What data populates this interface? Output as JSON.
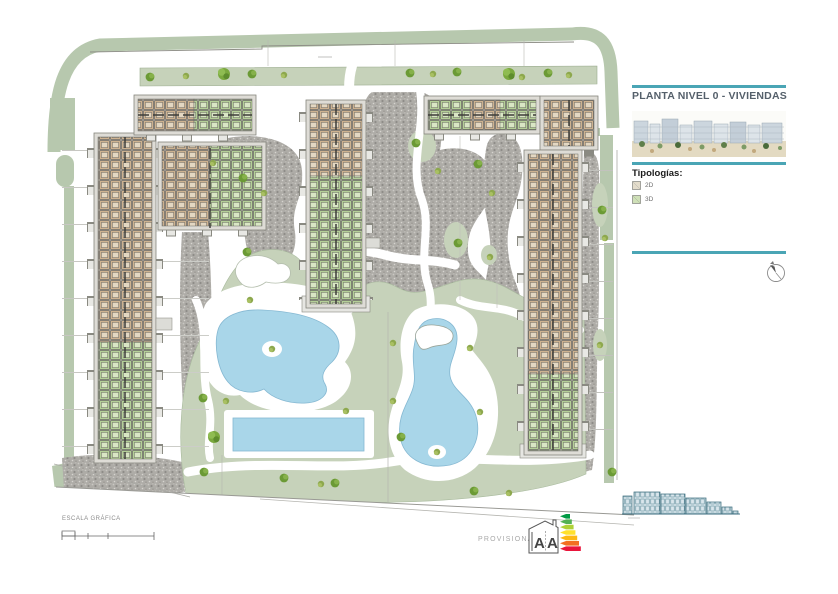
{
  "panel": {
    "title": "PLANTA NIVEL 0 - VIVIENDAS",
    "tipologias_heading": "Tipologías:",
    "legend": [
      {
        "label": "2D",
        "color": "#e3dccb"
      },
      {
        "label": "3D",
        "color": "#cfe0b8"
      }
    ]
  },
  "footer": {
    "scale_label": "ESCALA GRÁFICA",
    "provisional_label": "PROVISIONAL",
    "energy_letters": [
      "A",
      "A"
    ]
  },
  "colors": {
    "accent_teal": "#4aa5b5",
    "band_green": "#b7c8ae",
    "lawn_green": "#c6d2ba",
    "pool_blue": "#a9d6e9",
    "typology_2d": "#cdb290",
    "typology_3d": "#b4cf97",
    "gravel_gray": "#aeaca7",
    "elevation_blue": "#3f7184",
    "energy_arrow_colors": [
      "#009a44",
      "#52b153",
      "#aed136",
      "#ffe12c",
      "#fdb913",
      "#f36f21",
      "#e9153b"
    ]
  }
}
